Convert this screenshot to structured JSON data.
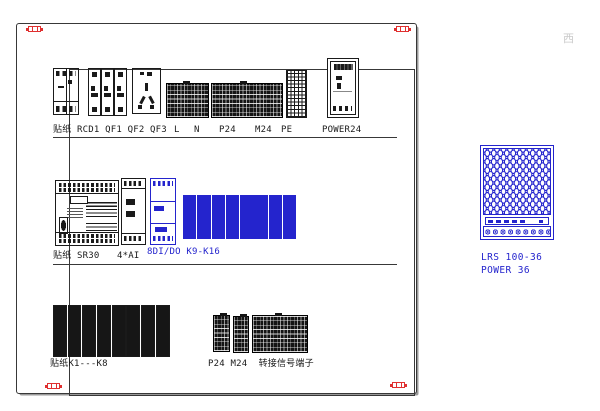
{
  "colors": {
    "ink": "#1a1a1a",
    "blue": "#2424cd",
    "red": "#e03030",
    "wm": "#c9c9c9"
  },
  "panel": {
    "row1": {
      "left_labels": "贴纸 RCD1 QF1 QF2 QF3",
      "terminal_l": "L",
      "terminal_n": "N",
      "terminal_p24": "P24",
      "terminal_m24": "M24",
      "terminal_pe": "PE",
      "power_label": "POWER24"
    },
    "row2": {
      "left_label": "贴纸 SR30",
      "ai_label": "4*AI",
      "dio_label": "8DI/DO K9-K16"
    },
    "row3": {
      "left_label": "贴纸K1---K8",
      "right_label": "P24 M24  转接信号端子"
    }
  },
  "psu": {
    "model": "LRS 100-36",
    "rating": "POWER 36"
  },
  "watermark": "西"
}
